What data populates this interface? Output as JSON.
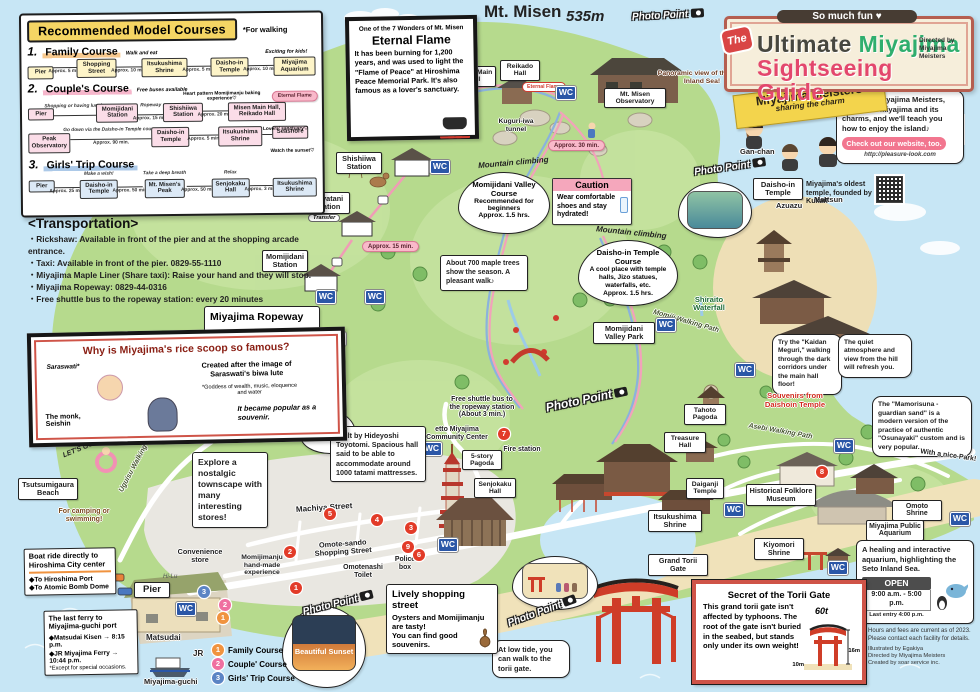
{
  "header": {
    "fun": "So much fun ♥",
    "the": "The",
    "t1": "Ultimate",
    "t2": "Miyajima",
    "line2": "Sightseeing Guide",
    "directed": "Directed by Miyajima Meisters"
  },
  "courses_panel": {
    "title": "Recommended Model Courses",
    "subtitle": "*For walking",
    "c1": {
      "num": "1.",
      "name": "Family Course",
      "note1": "Walk and eat",
      "note2": "Exciting for kids!",
      "s0": "Pier",
      "s1": "Shopping Street",
      "s2": "Itsukushima Shrine",
      "s3": "Daisho-in Temple",
      "s4": "Miyajima Aquarium",
      "t0": "Approx. 5 min.",
      "t1": "Approx. 10 min.",
      "t2": "Approx. 5 min.",
      "t3": "Approx. 10 min."
    },
    "c2": {
      "num": "2.",
      "name": "Couple's Course",
      "note_buses": "Free buses available",
      "note_heart": "Heart pattern Momijimanju baking experience♡",
      "note_flame": "Eternal Flame",
      "note_lovers": "Lovers' sanctuary♡",
      "note_shop": "Shopping or having lunch♪",
      "note_rope": "Ropeway",
      "note_down": "Go down via the Daisho-in Temple course",
      "note_sunset": "Watch the sunset♡",
      "r1s0": "Pier",
      "r1s1": "Momijidani Station",
      "r1s2": "Shishiiwa Station",
      "r1s3": "Misen Main Hall, Reikado Hall",
      "r1t1": "Approx. 15 min.",
      "r1t2": "Approx. 20 min.",
      "r2s0": "Peak Observatory",
      "r2s1": "Daisho-in Temple",
      "r2s2": "Itsukushima Shrine",
      "r2s3": "Seashore",
      "r2t0": "Approx. 90 min.",
      "r2t1": "Approx. 5 min."
    },
    "c3": {
      "num": "3.",
      "name": "Girls' Trip Course",
      "note1": "Make a wish!",
      "note2": "Take a deep breath",
      "note3": "Relax",
      "s0": "Pier",
      "s1": "Daisho-in Temple",
      "s2": "Mt. Misen's Peak",
      "s3": "Senjokaku Hall",
      "s4": "Itsukushima Shrine",
      "t0": "Approx. 25 min.",
      "t1": "Approx. 50 min.",
      "t2": "Approx. 50 min.",
      "t3": "Approx. 3 min."
    }
  },
  "transportation": {
    "title": "<Transportation>",
    "i0": "・Rickshaw: Available in front of the pier and at the shopping arcade entrance.",
    "i1": "・Taxi: Available in front of the pier. 0829-55-1110",
    "i2": "・Miyajima Maple Liner (Share taxi): Raise your hand and they will stop.",
    "i3": "・Miyajima Ropeway: 0829-44-0316",
    "i4": "・Free shuttle bus to the ropeway station: every 20 minutes"
  },
  "eternal_flame_box": {
    "kicker": "One of the 7 Wonders of Mt. Misen",
    "title": "Eternal Flame",
    "body": "It has been burning for 1,200 years, and was used to light the \"Flame of Peace\" at Hiroshima Peace Memorial Park. It's also famous as a lover's sanctuary."
  },
  "mt_misen": {
    "name": "Mt. Misen",
    "elev": "535m"
  },
  "meisters": {
    "banner1": "Miyajima Meisters",
    "banner2": "sharing the charm",
    "speech": "We're the Miyajima Meisters, experts in Miyajima and its charms, and we'll teach you how to enjoy the island♪",
    "cta": "Check out our website, too.",
    "url": "http://pleasure-look.com",
    "m1": "Gan-chan",
    "m2": "Azuazu",
    "m3": "Mattsun",
    "m4": "Ikepi"
  },
  "daishoin_info": {
    "label": "Daisho-in Temple",
    "desc": "Miyajima's oldest temple, founded by Kukai!"
  },
  "ropeway_box": {
    "title": "Miyajima Ropeway",
    "h1": "One way",
    "v1": "1,100 yen per adult",
    "h2": "Round trip",
    "v2": "2,000 yen per adult",
    "last": "<Last trip down> 4:30 p.m. (Mar. - Nov.)",
    "note": "*Check out our website for more details."
  },
  "rice_box": {
    "title": "Why is Miyajima's rice scoop so famous?",
    "saraswati": "Saraswati*",
    "created": "Created after the image of Saraswati's biwa lute",
    "goddess": "*Goddess of wealth, music, eloquence and water",
    "monk": "The monk, Seishin",
    "popular": "It became popular as a souvenir."
  },
  "climbing": {
    "arc": "Mountain climbing",
    "m_title": "Momijidani Valley Course",
    "m_body": "Recommended for beginners",
    "m_time": "Approx. 1.5 hrs.",
    "d_title": "Daisho-in Temple Course",
    "d_body": "A cool place with temple halls, Jizo statues, waterfalls, etc.",
    "d_time": "Approx. 1.5 hrs."
  },
  "caution": {
    "title": "Caution",
    "body": "Wear comfortable shoes and stay hydrated!"
  },
  "bubbles": {
    "panoramic": "Panoramic view of the Seto Inland Sea!",
    "maple": "About 700 maple trees show the season. A pleasant walk♪",
    "kaidan": "Try the \"Kaidan Meguri,\" walking through the dark corridors under the main hall floor!",
    "quiet": "The quiet atmosphere and view from the hill will refresh you.",
    "mamorisuna": "The \"Mamorisuna - guardian sand\" is a modern version of the practice of authentic \"Osunayaki\" custom and is very popular.",
    "souvenirs": "Souvenirs from Daishoin Temple",
    "cherry": "Beautiful cherry blossoms in spring!",
    "nostalgic": "Explore a nostalgic townscape with many interesting stores!",
    "camping": "For camping or swimming!",
    "lets_go": "LET'S GO!",
    "hideyoshi": "Built by Hideyoshi Toyotomi. Spacious hall said to be able to accommodate around 1000 tatami mattresses.",
    "shuttle": "Free shuttle bus to the ropeway station (About 3 min.)",
    "nice_park": "With a nice Park!",
    "aquarium": "A healing and interactive aquarium, highlighting the Seto Inland Sea.",
    "low_tide": "At low tide, you can walk to the torii gate.",
    "sunset": "Beautiful Sunset"
  },
  "shopping_box": {
    "title": "Lively shopping street",
    "b1": "Oysters and Momijimanju are tasty!",
    "b2": "You can find good souvenirs."
  },
  "torii_box": {
    "title": "Secret of the Torii Gate",
    "body": "This grand torii gate isn't affected by typhoons. The root of the gate isn't buried in the seabed, but stands only under its own weight!",
    "weight": "60t",
    "h": "16m",
    "d": "10m"
  },
  "open_box": {
    "open": "OPEN",
    "hours": "9:00 a.m. - 5:00 p.m.",
    "last": "Last entry 4:00 p.m."
  },
  "credits": {
    "c0": "Hours and fees are current as of 2023. Please contact each facility for details.",
    "c1": "Illustrated by Egakiya",
    "c2": "Directed by Miyajima Meisters",
    "c3": "Created by soar service inc."
  },
  "boat_box": {
    "title": "Boat ride directly to Hiroshima City center",
    "i1": "◆To Hiroshima Port",
    "i2": "◆To Atomic Bomb Dome"
  },
  "ferry_box": {
    "title": "The last ferry to Miyajima-guchi port",
    "i1": "◆Matsudai Kisen → 8:15 p.m.",
    "i2": "◆JR Miyajima Ferry → 10:44 p.m.",
    "note": "*Except for special occasions."
  },
  "legend": {
    "n1": "1",
    "l1": "Family Course",
    "n2": "2",
    "l2": "Couple' Course",
    "n3": "3",
    "l3": "Girls' Trip Course"
  },
  "badges": {
    "b1": "1",
    "b2": "2",
    "b3": "3",
    "b4": "4",
    "b5": "5",
    "b6": "6",
    "b7": "7",
    "b8": "8",
    "b9": "9"
  },
  "places": {
    "misen_main_hall": "Misen Main Hall",
    "reikado_hall": "Reikado Hall",
    "eternal_flame": "Eternal Flame",
    "kuguri": "Kuguri-iwa tunnel",
    "observatory": "Mt. Misen Observatory",
    "shishiiwa": "Shishiiwa Station",
    "kayatani": "Kayatani Station",
    "transfer": "Transfer",
    "momijidani_st": "Momijidani Station",
    "valley_park": "Momijidani Valley Park",
    "momiji_path": "Momiji Walking Path",
    "shiraito": "Shiraito Waterfall",
    "tahoto": "Tahoto Pagoda",
    "treasure": "Treasure Hall",
    "asebi": "Asebi Walking Path",
    "uguisu": "Uguisu Walking Path",
    "tsutsumigaura": "Tsutsumigaura Beach",
    "convenience": "Convenience store",
    "pier": "Pier",
    "machiya": "Machiya Street",
    "omotesando": "Omote-sando Shopping Street",
    "momijimanju": "Momijimanju hand-made experience",
    "omotenashi": "Omotenashi Toilet",
    "police": "Police box",
    "community": "etto Miyajima Community Center",
    "fire": "Fire station",
    "pagoda5": "5-story Pagoda",
    "senjokaku": "Senjokaku Hall",
    "itsukushima": "Itsukushima Shrine",
    "grand_torii": "Grand Torii Gate",
    "daiganji": "Daiganji Temple",
    "folklore": "Historical Folklore Museum",
    "kiyomori": "Kiyomori Shrine",
    "omoto": "Omoto Shrine",
    "aquarium": "Miyajima Public Aquarium",
    "matsudai": "Matsudai",
    "jr": "JR",
    "miyajima_guchi": "Miyajima-guchi"
  },
  "times": {
    "t15": "Approx. 15 min.",
    "t20": "Approx. 20 min.",
    "t30": "Approx. 30 min."
  },
  "misc": {
    "pp": "Photo Point",
    "wc": "WC",
    "hi": "Hi-Lu"
  }
}
